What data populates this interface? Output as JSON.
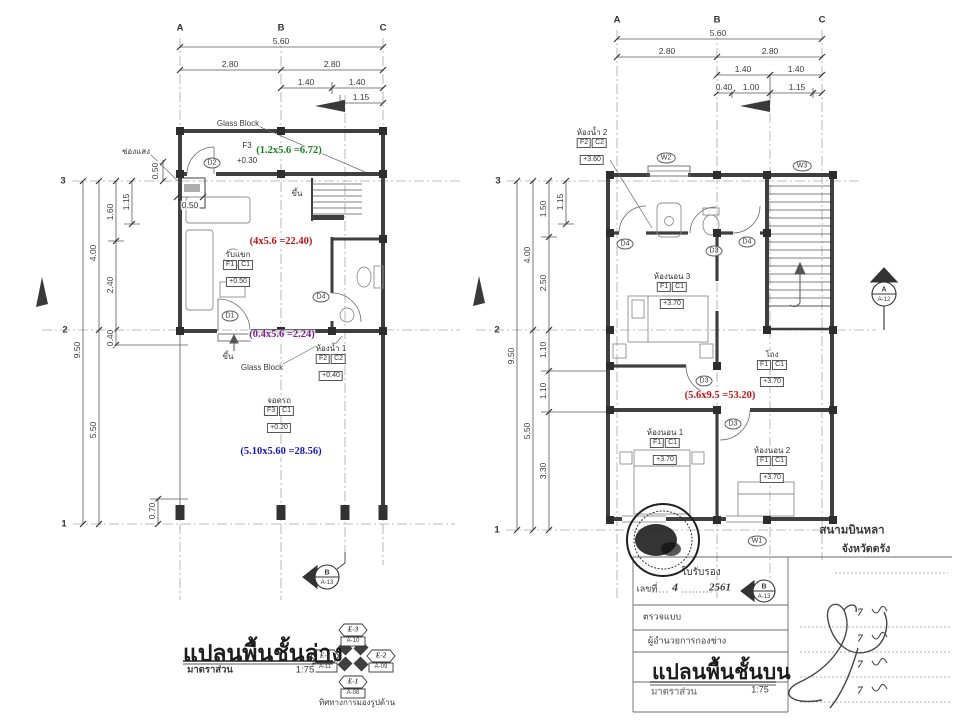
{
  "palette": {
    "ink": "#3a3a3a",
    "wall": "#3f3f3f",
    "light": "#8a8a8a",
    "green": "#17811c",
    "red": "#c41212",
    "blue": "#1515c8",
    "purple": "#7d1d96"
  },
  "grid": {
    "a": "A",
    "b": "B",
    "c": "C",
    "r1": "1",
    "r2": "2",
    "r3": "3"
  },
  "left_plan": {
    "dims_top": [
      "5.60",
      "2.80",
      "2.80",
      "1.40",
      "1.40",
      "1.15"
    ],
    "dims_left": [
      "1.15",
      "1.60",
      "4.00",
      "2.40",
      "9.50",
      "0.40",
      "5.50",
      "0.70"
    ],
    "dims_small": [
      "0.50",
      "0.50"
    ],
    "notes": {
      "vent": "ช่องแสง",
      "glass_top": "Glass Block",
      "glass_mid": "Glass Block",
      "up_stair": "ขึ้น",
      "up_entry": "ขึ้น"
    },
    "doors": {
      "d1": "D1",
      "d2": "D2",
      "d4": "D4"
    },
    "entry": {
      "f": "F3",
      "level": "+0.30"
    },
    "living": {
      "name": "รับแขก",
      "f": "F1",
      "c": "C1",
      "level": "+0.50"
    },
    "bath": {
      "name": "ห้องน้ำ 1",
      "f": "F2",
      "c": "C2",
      "level": "+0.40"
    },
    "carport": {
      "name": "จอดรถ",
      "f": "F3",
      "c": "C1",
      "level": "+0.20"
    },
    "calcs": {
      "green": "(1.2x5.6 =6.72)",
      "red": "(4x5.6 =22.40)",
      "purple": "(0.4x5.6 =2.24)",
      "blue": "(5.10x5.60 =28.56)"
    },
    "marker_b": {
      "label": "B",
      "sheet": "A-13"
    },
    "title": "แปลนพื้นชั้นล่าง",
    "scale_label": "มาตราส่วน",
    "scale_value": "1:75"
  },
  "compass": {
    "caption": "ทิศทางการมองรูปด้าน",
    "north": {
      "code": "E-3",
      "sheet": "A-10"
    },
    "east": {
      "code": "E-2",
      "sheet": "A-09"
    },
    "south": {
      "code": "E-1",
      "sheet": "A-08"
    },
    "west": {
      "code": "E-4",
      "sheet": "A-11"
    }
  },
  "right_plan": {
    "dims_top": [
      "5.60",
      "2.80",
      "2.80",
      "1.40",
      "1.40",
      "0.40",
      "1.00",
      "1.15"
    ],
    "dims_left": [
      "1.15",
      "1.50",
      "4.00",
      "2.50",
      "9.50",
      "1.10",
      "1.10",
      "5.50",
      "3.30"
    ],
    "windows": {
      "w1": "W1",
      "w2": "W2",
      "w3": "W3"
    },
    "doors": {
      "d4a": "D4",
      "d3a": "D3",
      "d4b": "D4",
      "d3b": "D3",
      "d3c": "D3"
    },
    "bath2": {
      "name": "ห้องน้ำ 2",
      "f": "F2",
      "c": "C2",
      "level": "+3.60"
    },
    "bed3": {
      "name": "ห้องนอน 3",
      "f": "F1",
      "c": "C1",
      "level": "+3.70"
    },
    "hall": {
      "name": "โถง",
      "f": "F1",
      "c": "C1",
      "level": "+3.70"
    },
    "bed1": {
      "name": "ห้องนอน 1",
      "f": "F1",
      "c": "C1",
      "level": "+3.70"
    },
    "bed2": {
      "name": "ห้องนอน 2",
      "f": "F1",
      "c": "C1",
      "level": "+3.70"
    },
    "calcs": {
      "red": "(5.6x9.5 =53.20)"
    },
    "marker_a": {
      "label": "A",
      "sheet": "A-12"
    },
    "marker_b": {
      "label": "B",
      "sheet": "A-13"
    },
    "title": "แปลนพื้นชั้นบน",
    "scale_label": "มาตราส่วน",
    "scale_value": "1:75"
  },
  "title_block": {
    "stamp_line1": "สนามบินหลา",
    "stamp_line2": "จังหวัดตรัง",
    "cert": "ใบรับรอง",
    "no_label": "เลขที่",
    "no_value": "4",
    "no_year": "2561",
    "row_check": "ตรวจแบบ",
    "row_director": "ผู้อำนวยการกองช่าง",
    "date_mark": "7"
  }
}
